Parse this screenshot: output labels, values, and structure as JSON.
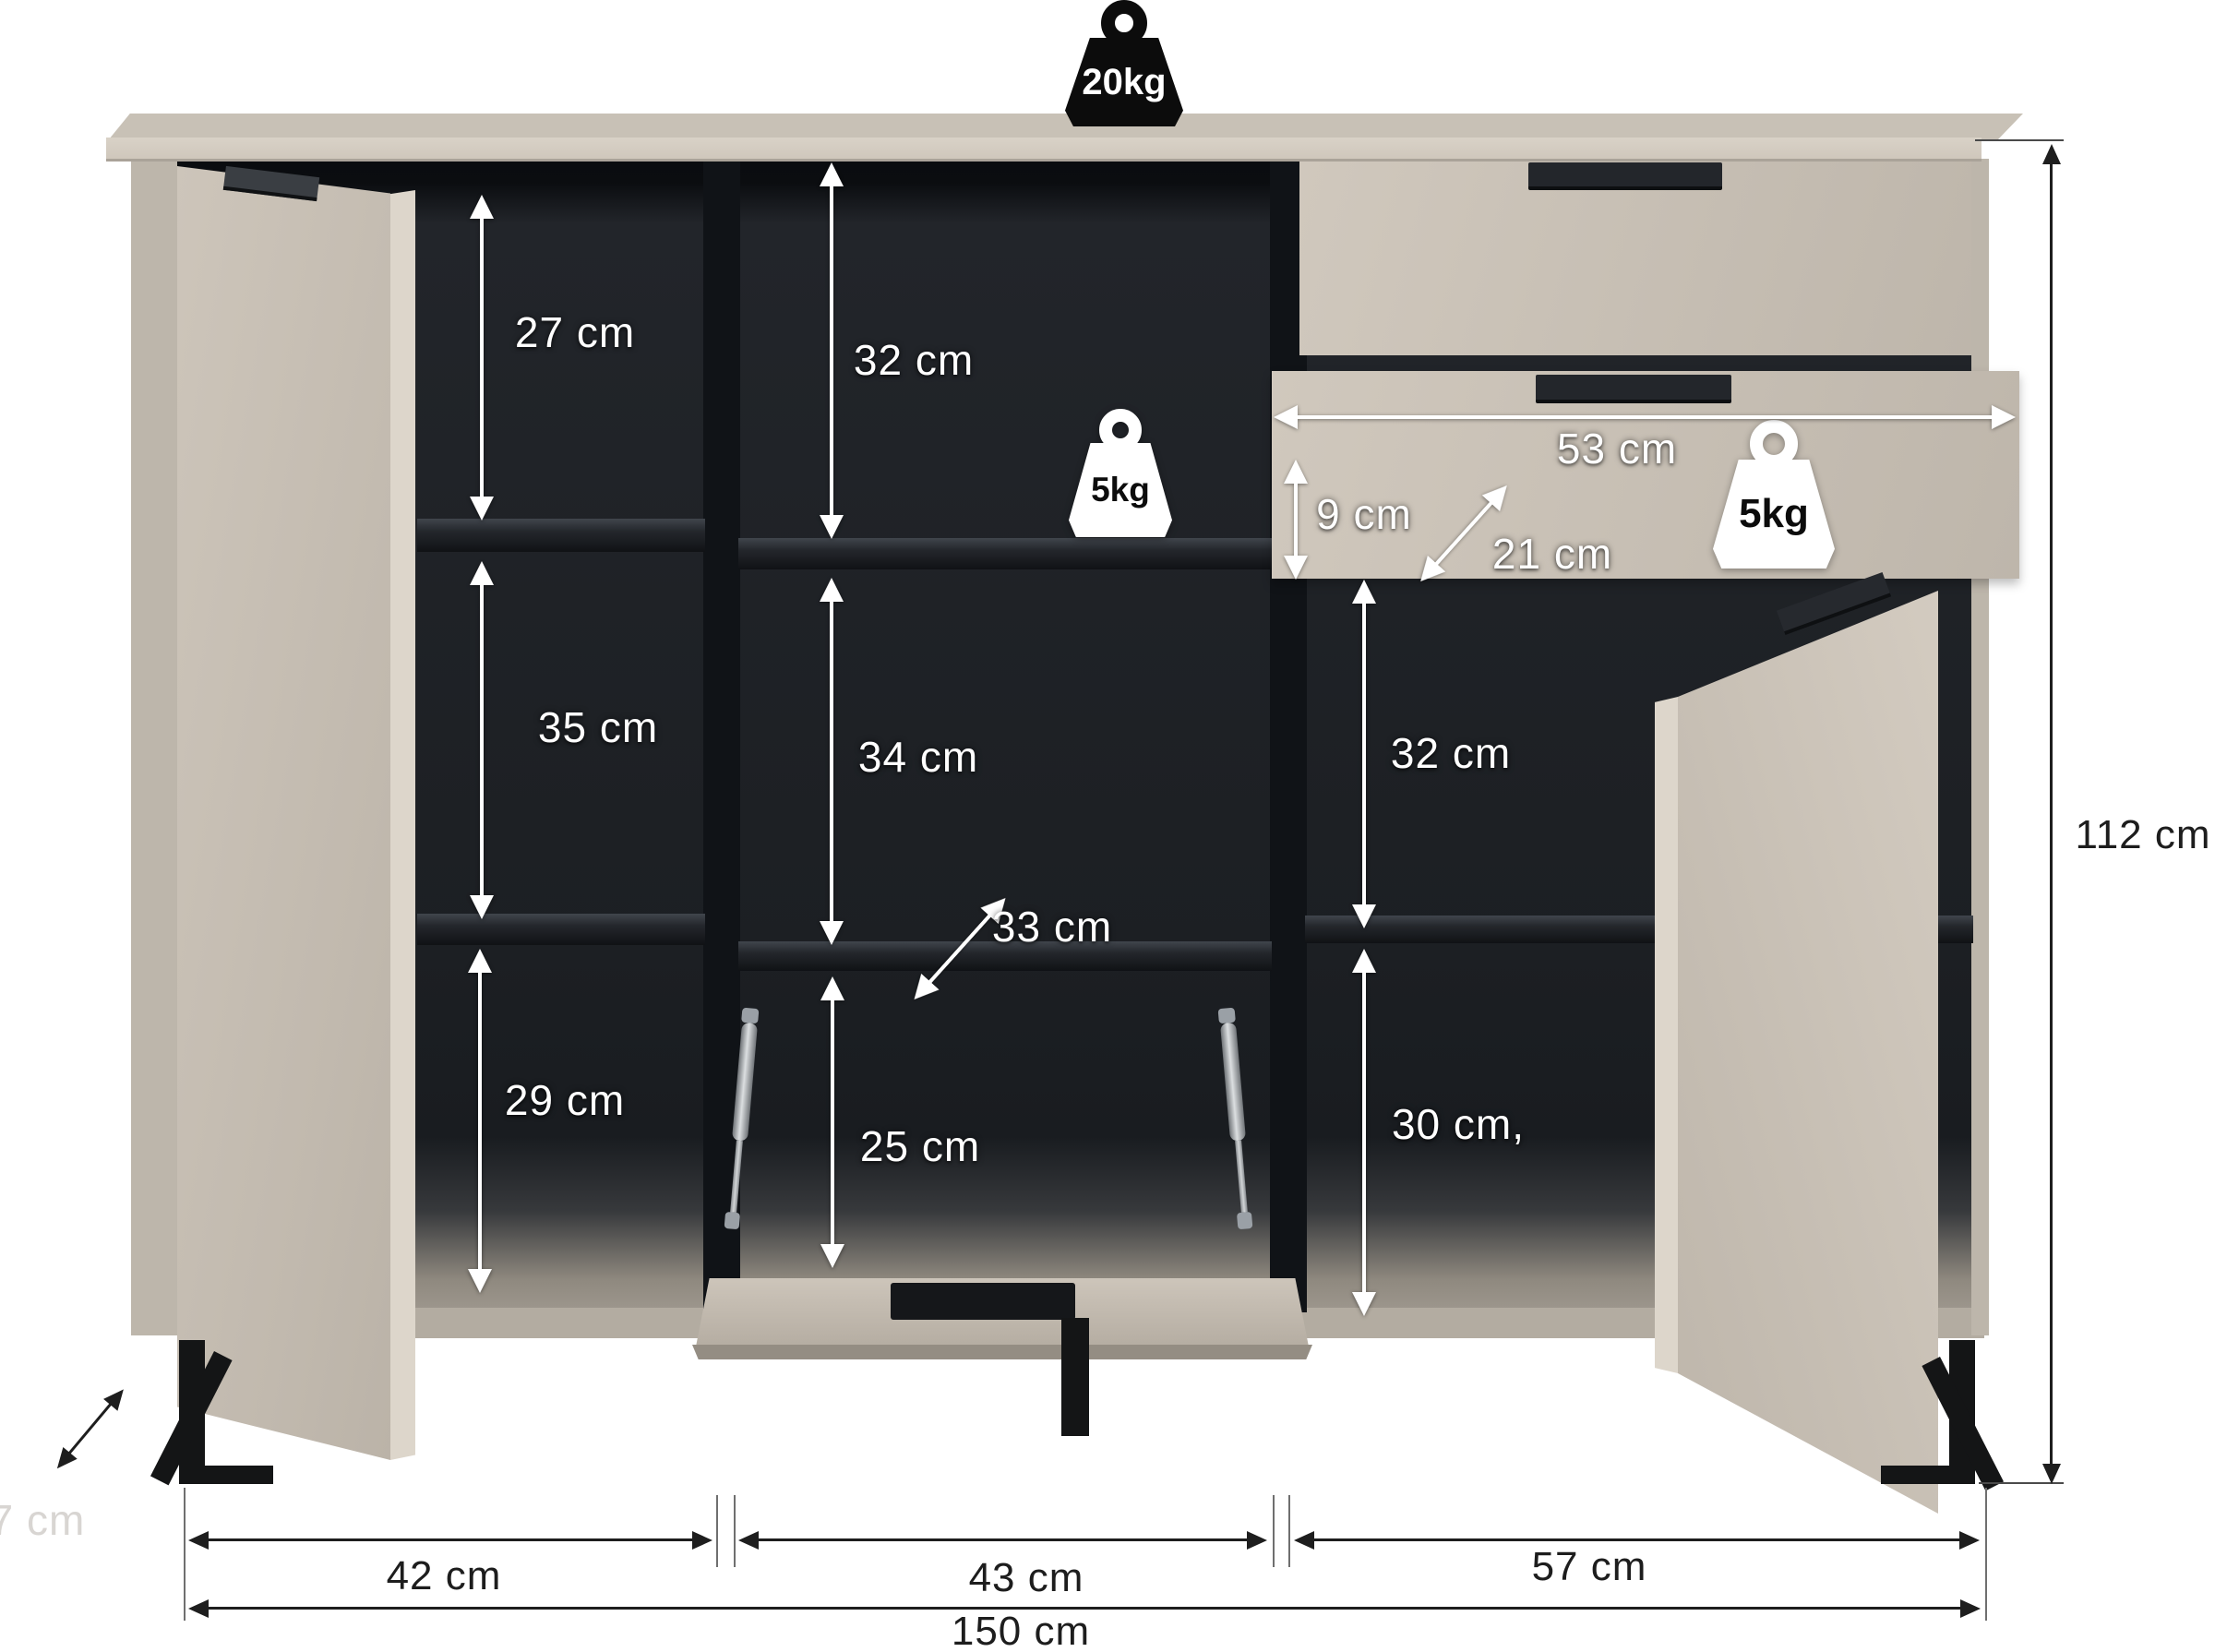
{
  "diagram": {
    "description": "Sideboard dimension diagram with open doors, open flap and pulled-out drawer",
    "top_load_label": "20kg",
    "left_column": {
      "compartments": [
        {
          "height_label": "27 cm"
        },
        {
          "height_label": "35 cm"
        },
        {
          "height_label": "29 cm"
        }
      ]
    },
    "middle_column": {
      "top_height_label": "32 cm",
      "shelf_load_label": "5kg",
      "middle_height_label": "34 cm",
      "shelf_depth_label": "33 cm",
      "flap_opening_height_label": "25 cm"
    },
    "drawer": {
      "width_label": "53 cm",
      "inner_height_label": "9 cm",
      "inner_depth_label": "21 cm",
      "load_label": "5kg"
    },
    "right_column": {
      "top_height_label": "32 cm",
      "bottom_height_label": "30 cm,"
    },
    "overall": {
      "height_label": "112 cm",
      "width_label": "150 cm",
      "depth_label": "37 cm"
    },
    "bottom_sections": [
      {
        "width_label": "42 cm"
      },
      {
        "width_label": "43 cm"
      },
      {
        "width_label": "57 cm"
      }
    ],
    "colors": {
      "body": "#c6beb3",
      "interior": "#1c1f23",
      "annotation_light": "#ffffff",
      "annotation_dark": "#1e1e1e",
      "legs": "#141516"
    }
  }
}
